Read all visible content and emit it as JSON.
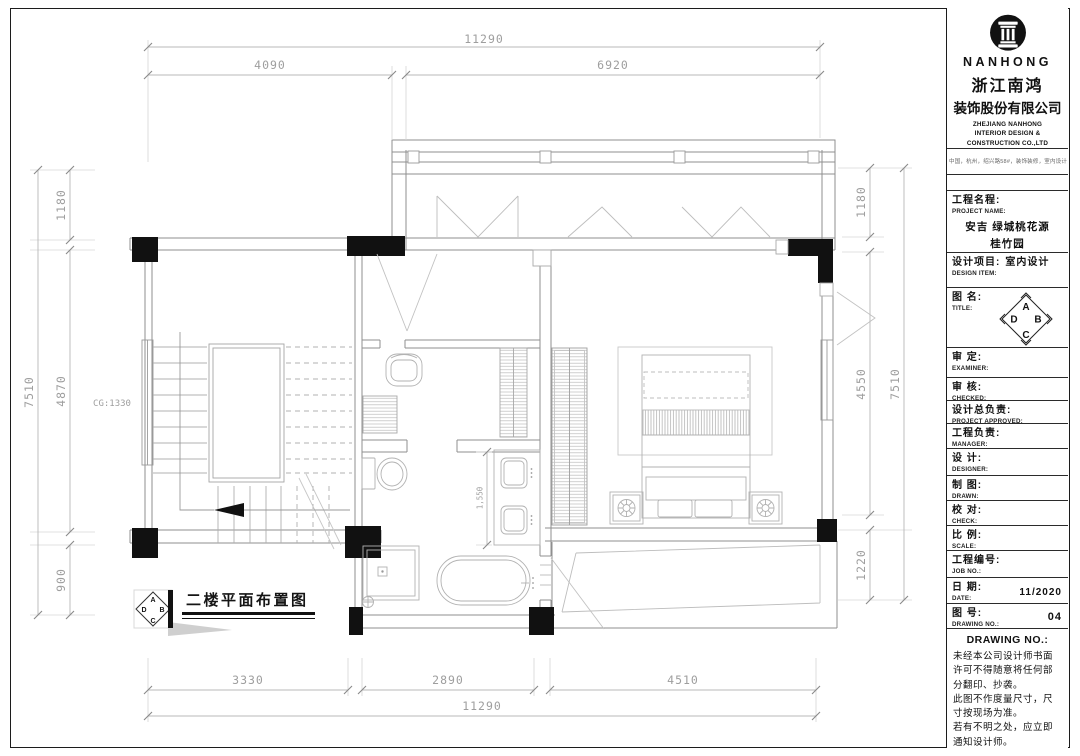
{
  "plan": {
    "label": "二楼平面布置图",
    "cg_note": "CG:1330",
    "bath_dim": "1,550",
    "dims": {
      "top_overall": "11290",
      "top_a": "4090",
      "top_b": "6920",
      "left_overall": "7510",
      "left_a": "1180",
      "left_b": "4870",
      "left_c": "900",
      "right_a": "1180",
      "right_b": "4550",
      "right_c": "1220",
      "right_overall": "7510",
      "bottom_a": "3330",
      "bottom_b": "2890",
      "bottom_c": "4510",
      "bottom_overall": "11290"
    }
  },
  "compass": {
    "a": "A",
    "b": "B",
    "c": "C",
    "d": "D"
  },
  "titleblock": {
    "brand": {
      "name": "NANHONG",
      "cn_line1": "浙江南鸿",
      "cn_line2": "装饰股份有限公司",
      "en_line1": "ZHEJIANG NANHONG",
      "en_line2": "INTERIOR DESIGN &",
      "en_line3": "CONSTRUCTION CO.,LTD",
      "tagline": "中国，杭州，绍兴路58#，装饰装修，室内设计"
    },
    "fields": [
      {
        "cn": "工程名程:",
        "en": "PROJECT NAME:",
        "value": "安吉 绿城桃花源\n桂竹园"
      },
      {
        "cn": "设计项目:",
        "en": "DESIGN ITEM:",
        "value": "室内设计"
      },
      {
        "cn": "图 名:",
        "en": "TITLE:"
      },
      {
        "cn": "审 定:",
        "en": "EXAMINER:"
      },
      {
        "cn": "审 核:",
        "en": "CHECKED:"
      },
      {
        "cn": "设计总负责:",
        "en": "PROJECT APPROVED:"
      },
      {
        "cn": "工程负责:",
        "en": "MANAGER:"
      },
      {
        "cn": "设 计:",
        "en": "DESIGNER:"
      },
      {
        "cn": "制 图:",
        "en": "DRAWN:"
      },
      {
        "cn": "校 对:",
        "en": "CHECK:"
      },
      {
        "cn": "比 例:",
        "en": "SCALE:"
      },
      {
        "cn": "工程编号:",
        "en": "JOB NO.:"
      },
      {
        "cn": "日 期:",
        "en": "DATE:",
        "value": "11/2020"
      },
      {
        "cn": "图 号:",
        "en": "DRAWING NO.:",
        "value": "04"
      }
    ],
    "notes": {
      "header": "DRAWING NO.:",
      "body": "未经本公司设计师书面\n许可不得随意将任何部\n分翻印、抄袭。\n此图不作度量尺寸，尺\n寸按现场为准。\n若有不明之处，应立即\n通知设计师。"
    }
  }
}
